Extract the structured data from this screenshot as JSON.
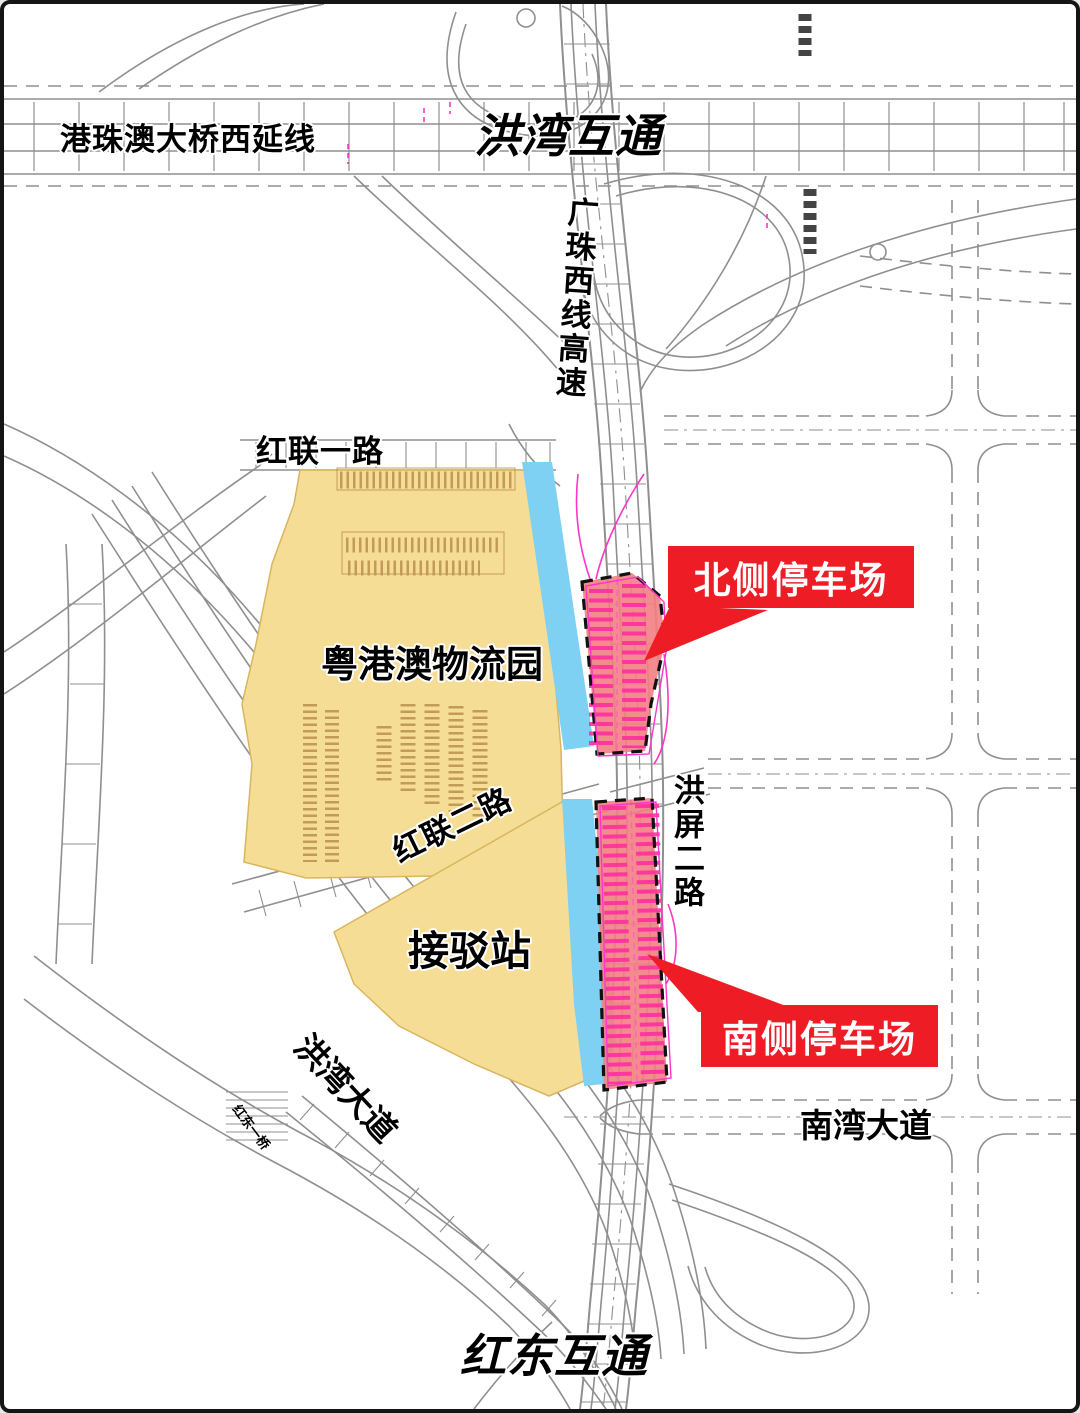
{
  "map_title": "洪湾停车场选址示意图",
  "labels": {
    "bridge_west_extension": "港珠澳大桥西延线",
    "hongwan_interchange": "洪湾互通",
    "guangzhu_west_expressway": "广珠西线高速",
    "honglian_road_1": "红联一路",
    "logistics_park": "粤港澳物流园",
    "honglian_road_2": "红联二路",
    "hongping_road_2": "洪屏二路",
    "transfer_station": "接驳站",
    "hongwan_avenue": "洪湾大道",
    "nanwan_avenue": "南湾大道",
    "hongdong_interchange": "红东互通",
    "hongdong_bridge": "红东一桥"
  },
  "callouts": {
    "north_parking": "北侧停车场",
    "south_parking": "南侧停车场"
  },
  "colors": {
    "callout_red": "#ee1c25",
    "parcel_yellow": "#f6dd96",
    "parcel_edge": "#d9b55e",
    "canal_blue": "#7ed1f2",
    "parking_fill": "#f37e82",
    "parking_stripe": "#ff2f9e",
    "magenta_accent": "#ff35c8",
    "road_gray": "#8f8f8f"
  }
}
